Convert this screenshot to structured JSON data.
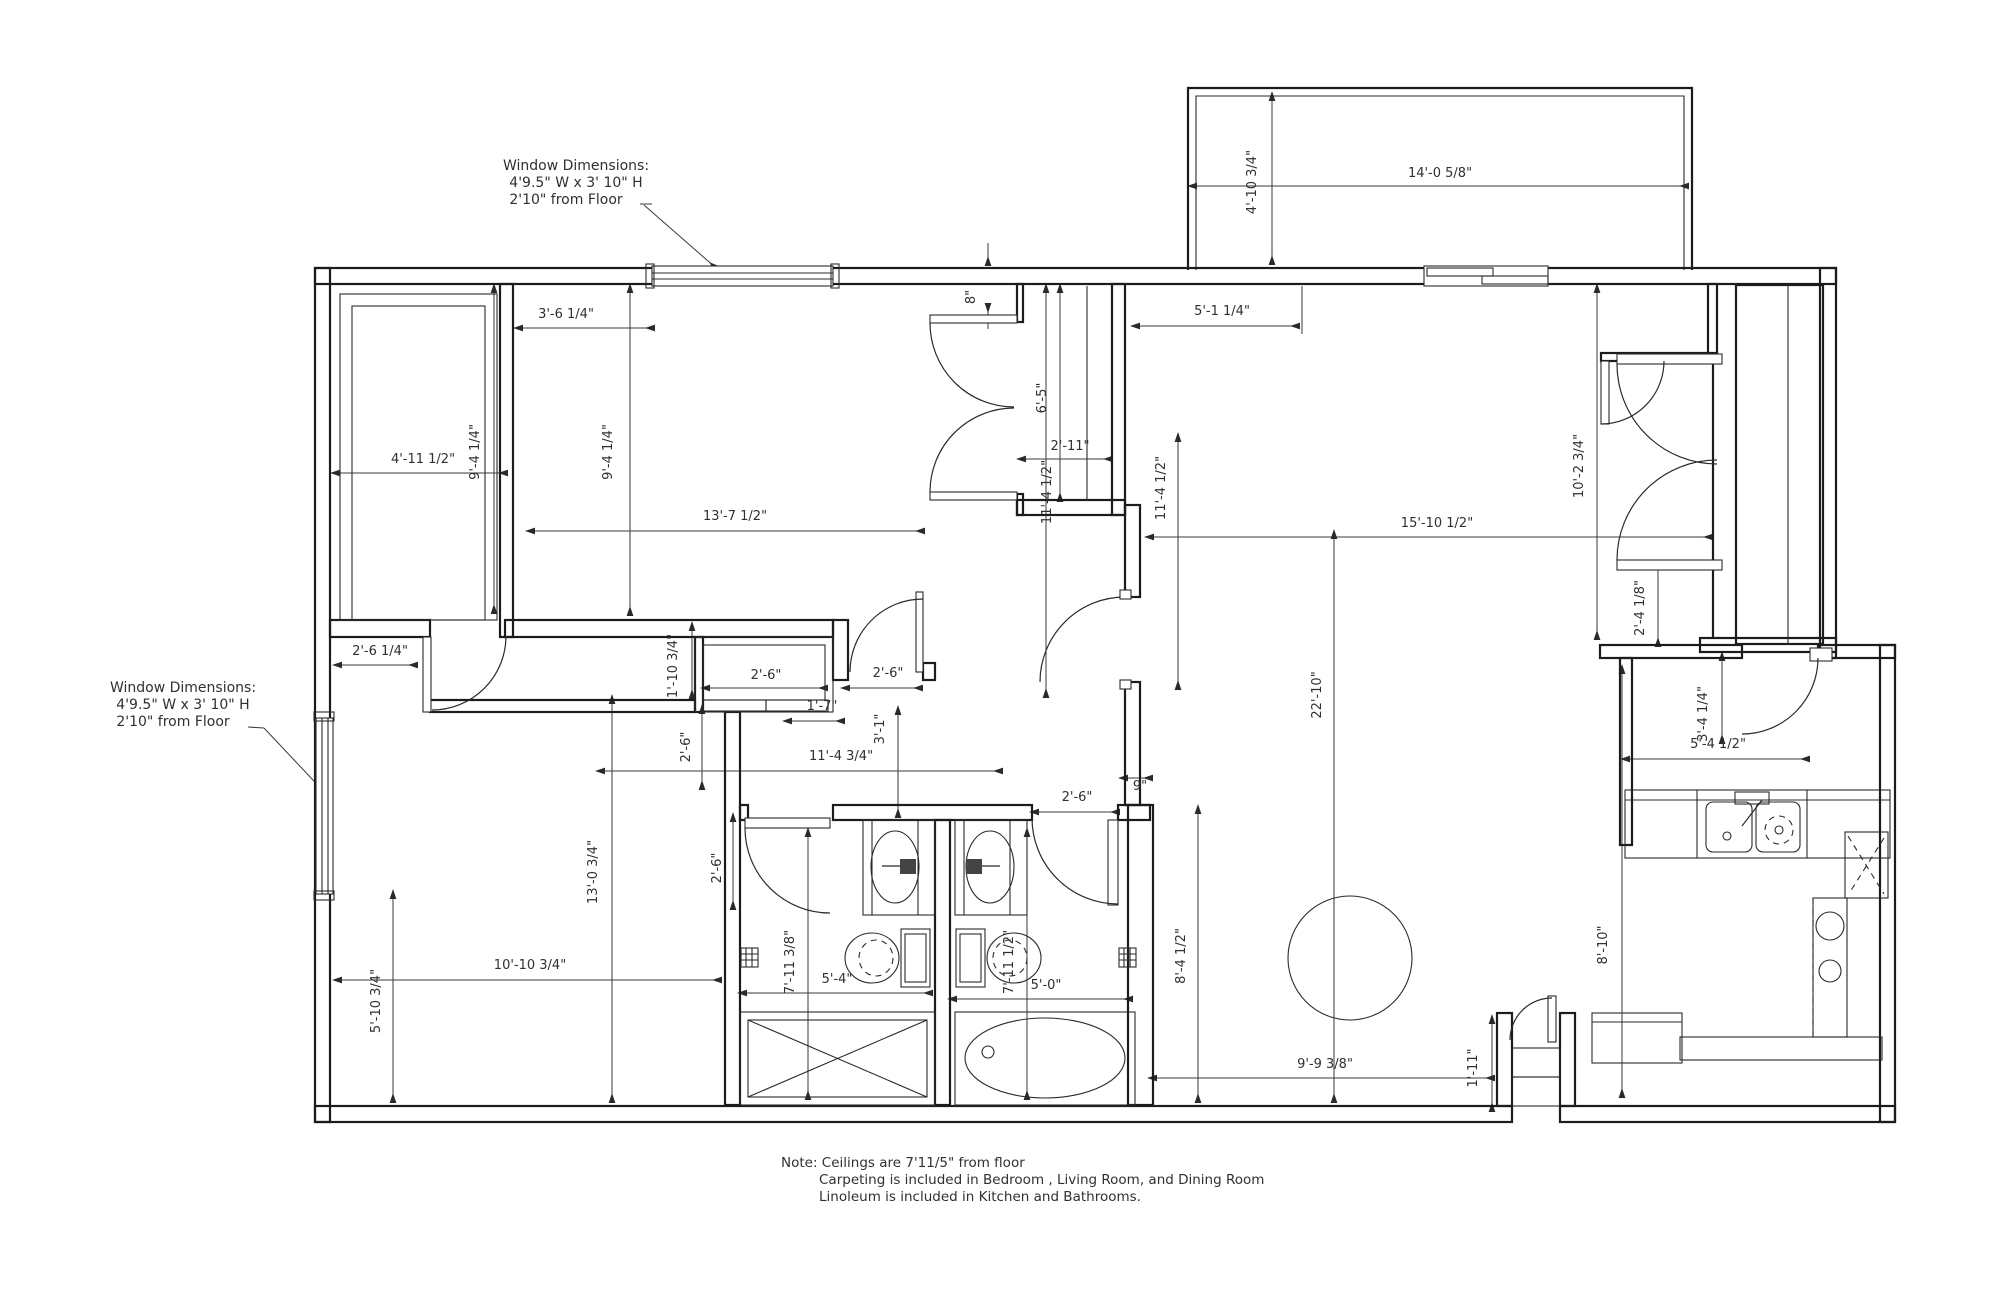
{
  "drawing": {
    "type": "apartment-floor-plan",
    "background": "#ffffff",
    "line_color": "#1c1c1c"
  },
  "callout_top": {
    "lines": [
      "Window Dimensions:",
      "4'9.5\" W x 3' 10\" H",
      "2'10\" from Floor"
    ],
    "positions": [
      [
        576,
        170
      ],
      [
        576,
        187
      ],
      [
        566,
        204
      ]
    ]
  },
  "callout_left": {
    "lines": [
      "Window Dimensions:",
      "4'9.5\" W x 3' 10\" H",
      "2'10\" from Floor"
    ],
    "positions": [
      [
        183,
        692
      ],
      [
        183,
        709
      ],
      [
        173,
        726
      ]
    ]
  },
  "note": {
    "lines": [
      "Note: Ceilings are 7'11/5\" from floor",
      "Carpeting is included in Bedroom , Living Room, and Dining Room",
      "Linoleum is included in Kitchen and Bathrooms."
    ],
    "positions": [
      [
        781,
        1167
      ],
      [
        819,
        1184
      ],
      [
        819,
        1201
      ]
    ]
  },
  "dim_labels": [
    {
      "text": "4'-10 3/4\"",
      "x": 1256,
      "y": 182,
      "r": -90
    },
    {
      "text": "14'-0 5/8\"",
      "x": 1440,
      "y": 177,
      "r": 0
    },
    {
      "text": "3'-6 1/4\"",
      "x": 566,
      "y": 318,
      "r": 0
    },
    {
      "text": "8\"",
      "x": 975,
      "y": 297,
      "r": -90
    },
    {
      "text": "5'-1 1/4\"",
      "x": 1222,
      "y": 315,
      "r": 0
    },
    {
      "text": "6'-5\"",
      "x": 1046,
      "y": 398,
      "r": -90
    },
    {
      "text": "2'-11\"",
      "x": 1070,
      "y": 450,
      "r": 0
    },
    {
      "text": "9'-4 1/4\"",
      "x": 479,
      "y": 452,
      "r": -90
    },
    {
      "text": "9'-4 1/4\"",
      "x": 612,
      "y": 452,
      "r": -90
    },
    {
      "text": "4'-11 1/2\"",
      "x": 423,
      "y": 463,
      "r": 0
    },
    {
      "text": "11'-4 1/2\"",
      "x": 1051,
      "y": 492,
      "r": -90
    },
    {
      "text": "11'-4 1/2\"",
      "x": 1165,
      "y": 488,
      "r": -90
    },
    {
      "text": "13'-7 1/2\"",
      "x": 735,
      "y": 520,
      "r": 0
    },
    {
      "text": "15'-10 1/2\"",
      "x": 1437,
      "y": 527,
      "r": 0
    },
    {
      "text": "10'-2 3/4\"",
      "x": 1583,
      "y": 466,
      "r": -90
    },
    {
      "text": "2'-4 1/8\"",
      "x": 1644,
      "y": 608,
      "r": -90
    },
    {
      "text": "2'-6 1/4\"",
      "x": 380,
      "y": 655,
      "r": 0
    },
    {
      "text": "1'-10 3/4\"",
      "x": 677,
      "y": 666,
      "r": -90
    },
    {
      "text": "2'-6\"",
      "x": 766,
      "y": 679,
      "r": 0
    },
    {
      "text": "2'-6\"",
      "x": 888,
      "y": 677,
      "r": 0
    },
    {
      "text": "1'-7\"",
      "x": 822,
      "y": 710,
      "r": 0
    },
    {
      "text": "3'-1\"",
      "x": 884,
      "y": 729,
      "r": -90
    },
    {
      "text": "22'-10\"",
      "x": 1321,
      "y": 695,
      "r": -90
    },
    {
      "text": "11'-4 3/4\"",
      "x": 841,
      "y": 760,
      "r": 0
    },
    {
      "text": "2'-6\"",
      "x": 690,
      "y": 747,
      "r": -90
    },
    {
      "text": "3'-4 1/4\"",
      "x": 1707,
      "y": 714,
      "r": -90
    },
    {
      "text": "5'-4 1/2\"",
      "x": 1718,
      "y": 748,
      "r": 0
    },
    {
      "text": "2'-6\"",
      "x": 1077,
      "y": 801,
      "r": 0
    },
    {
      "text": "9\"",
      "x": 1140,
      "y": 790,
      "r": 0
    },
    {
      "text": "2'-6\"",
      "x": 721,
      "y": 868,
      "r": -90
    },
    {
      "text": "13'-0 3/4\"",
      "x": 597,
      "y": 872,
      "r": -90
    },
    {
      "text": "8'-10\"",
      "x": 1607,
      "y": 945,
      "r": -90
    },
    {
      "text": "8'-4 1/2\"",
      "x": 1185,
      "y": 956,
      "r": -90
    },
    {
      "text": "7'-11 3/8\"",
      "x": 794,
      "y": 962,
      "r": -90
    },
    {
      "text": "7'-11 1/2\"",
      "x": 1013,
      "y": 962,
      "r": -90
    },
    {
      "text": "10'-10 3/4\"",
      "x": 530,
      "y": 969,
      "r": 0
    },
    {
      "text": "5'-4\"",
      "x": 837,
      "y": 983,
      "r": 0
    },
    {
      "text": "5'-0\"",
      "x": 1046,
      "y": 989,
      "r": 0
    },
    {
      "text": "5'-10 3/4\"",
      "x": 380,
      "y": 1001,
      "r": -90
    },
    {
      "text": "1'-11\"",
      "x": 1477,
      "y": 1068,
      "r": -90
    },
    {
      "text": "9'-9 3/8\"",
      "x": 1325,
      "y": 1068,
      "r": 0
    }
  ]
}
